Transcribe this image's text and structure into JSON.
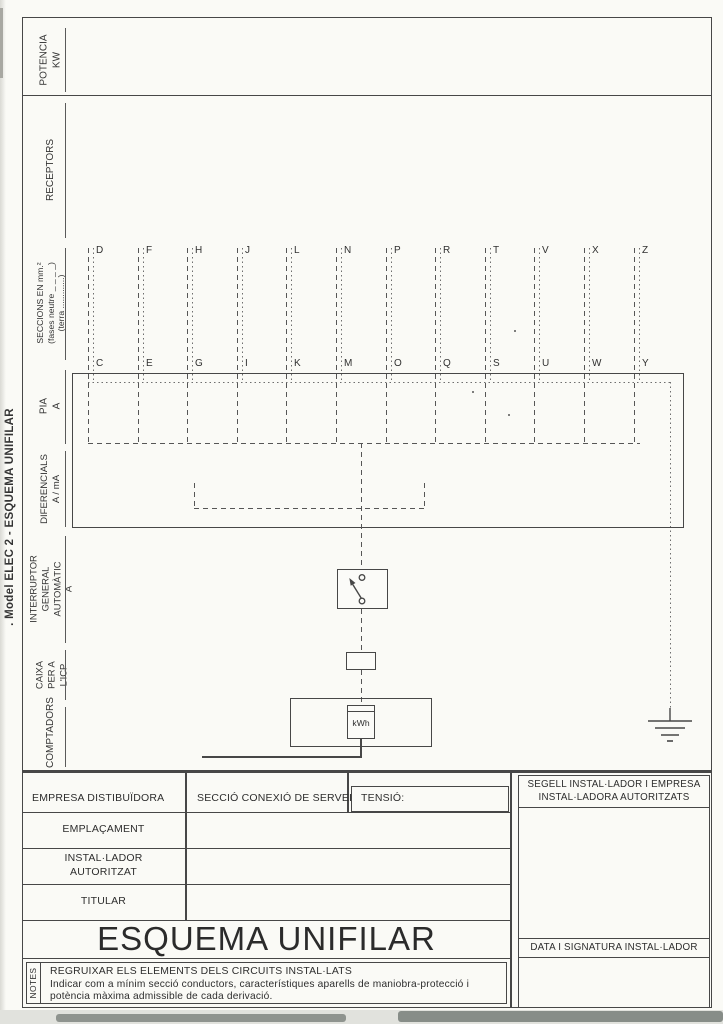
{
  "side_title": ". Model ELEC 2 - ESQUEMA UNIFILAR",
  "sidebar": {
    "potencia": "POTENCIA\nKW",
    "receptors": "RECEPTORS",
    "seccions": "SECCIONS EN mm.²\n(fases neutre _ _ _ _)\n(terra .............)",
    "pia": "PIA\nA",
    "diferencials": "DIFERENCIALS\nA / mA",
    "interruptor": "INTERRUPTOR GENERAL\nAUTOMÀTIC\nA",
    "caixa": "CAIXA\nPER A\nL'ICP",
    "comptadors": "COMPTADORS"
  },
  "circuits": {
    "top": [
      "D",
      "F",
      "H",
      "J",
      "L",
      "N",
      "P",
      "R",
      "T",
      "V",
      "X",
      "Z"
    ],
    "bottom": [
      "C",
      "E",
      "G",
      "I",
      "K",
      "M",
      "O",
      "Q",
      "S",
      "U",
      "W",
      "Y"
    ]
  },
  "diagram": {
    "meter_label": "kWh"
  },
  "form": {
    "empresa": "EMPRESA DISTIBUÏDORA",
    "seccio": "SECCIÓ CONEXIÓ DE SERVEI",
    "tensio": "TENSIÓ:",
    "emplacament": "EMPLAÇAMENT",
    "installador": "INSTAL·LADOR\nAUTORITZAT",
    "titular": "TITULAR",
    "title": "ESQUEMA UNIFILAR",
    "segell": "SEGELL INSTAL·LADOR I EMPRESA\nINSTAL·LADORA AUTORITZATS",
    "data_signatura": "DATA I SIGNATURA INSTAL·LADOR",
    "notes_label": "NOTES",
    "notes_heading": "REGRUIXAR ELS ELEMENTS DELS CIRCUITS INSTAL·LATS",
    "notes_body": "Indicar com a mínim secció conductors,  característiques aparells de maniobra-protecció i potència màxima admissible  de cada derivació."
  },
  "colors": {
    "ink": "#3b3b3b",
    "line": "#474747",
    "paper": "#fafaf6"
  }
}
